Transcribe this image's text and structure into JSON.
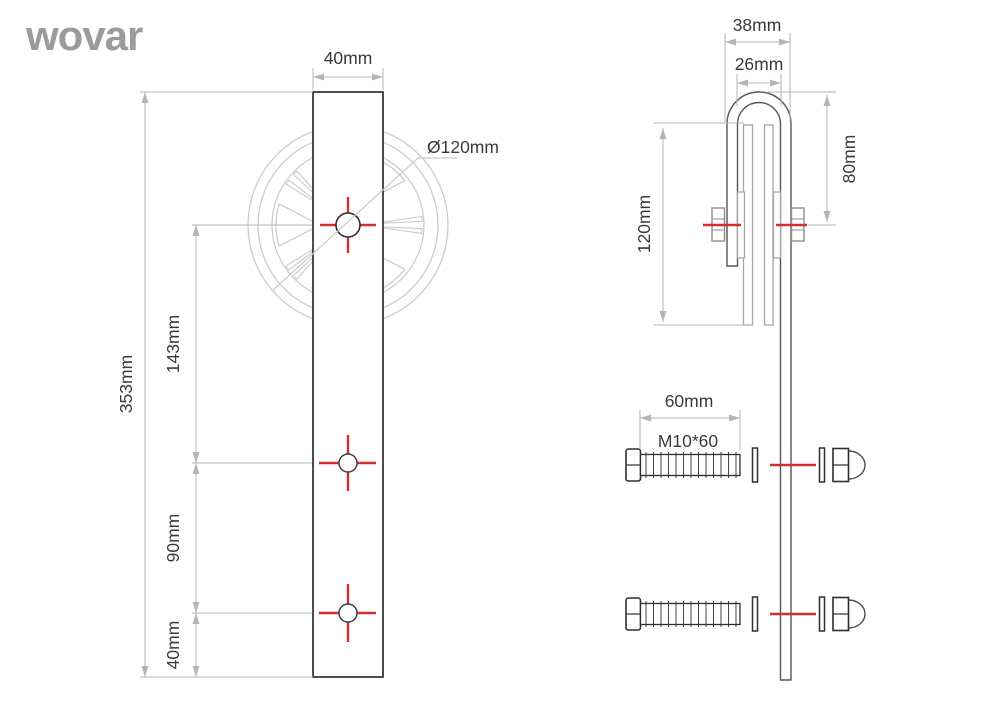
{
  "brand": {
    "logo": "wovar"
  },
  "front_view": {
    "bar_width": "40mm",
    "wheel_diameter": "Ø120mm",
    "total_height": "353mm",
    "center_to_hole": "143mm",
    "hole_to_hole": "90mm",
    "hole_to_end": "40mm"
  },
  "side_view": {
    "hook_outer_width": "38mm",
    "hook_inner_width": "26mm",
    "wheel_height": "120mm",
    "top_to_axle": "80mm"
  },
  "fasteners": {
    "bolt_length": "60mm",
    "bolt_spec": "M10*60"
  },
  "colors": {
    "accent_red": "#d03030",
    "dimension_gray": "#b5b5b5",
    "drawing_light_gray": "#c9c9c9",
    "drawing_dark": "#2f2f2f",
    "logo_gray": "#9b9b9b"
  }
}
